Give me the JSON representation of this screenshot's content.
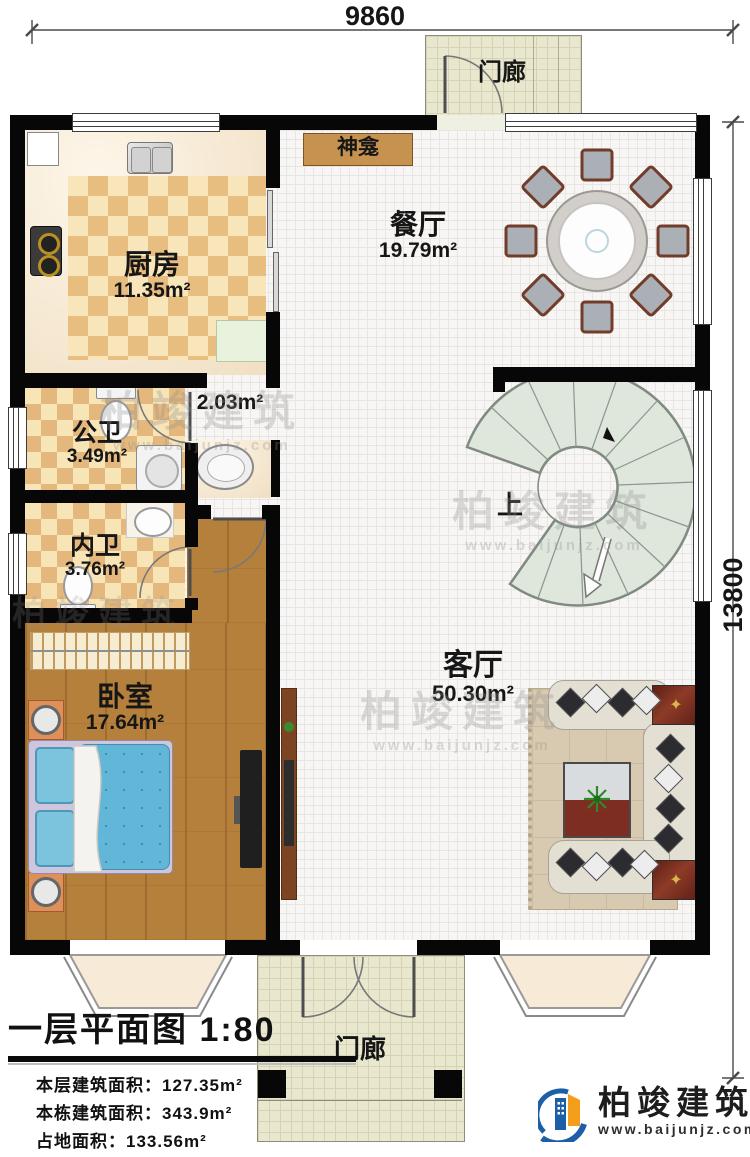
{
  "dimensions": {
    "width_label": "9860",
    "height_label": "13800"
  },
  "rooms": {
    "porch_top": {
      "label": "门廊"
    },
    "kitchen": {
      "label": "厨房",
      "area": "11.35m²"
    },
    "dining": {
      "label": "餐厅",
      "area": "19.79m²"
    },
    "shrine": {
      "label": "神龛"
    },
    "public_bath": {
      "label": "公卫",
      "area": "3.49m²"
    },
    "hallway": {
      "area": "2.03m²"
    },
    "inner_bath": {
      "label": "内卫",
      "area": "3.76m²"
    },
    "bedroom": {
      "label": "卧室",
      "area": "17.64m²"
    },
    "living": {
      "label": "客厅",
      "area": "50.30m²"
    },
    "stairs": {
      "up_label": "上"
    },
    "porch_bottom": {
      "label": "门廊"
    }
  },
  "info": {
    "title": "一层平面图",
    "scale": "1:80",
    "lines": [
      "本层建筑面积：127.35m²",
      "本栋建筑面积：343.9m²",
      "占地面积：133.56m²",
      "层高：3.8m"
    ]
  },
  "branding": {
    "company": "柏竣建筑",
    "website": "www.baijunjz.com"
  },
  "watermark": {
    "text": "柏竣建筑",
    "url": "www.baijunjz.com"
  },
  "colors": {
    "wall": "#070707",
    "checker": "#e8bd80",
    "wood": "#b5803c",
    "stair": "#dfe6dc",
    "logo_blue": "#1c5fa8",
    "logo_orange": "#f49f1c"
  }
}
